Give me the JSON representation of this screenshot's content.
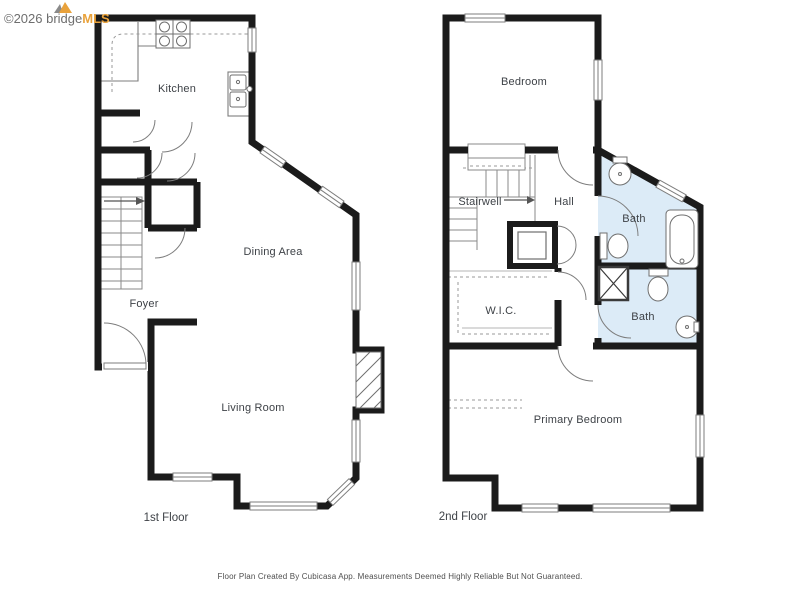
{
  "logo": {
    "prefix": "©2026 bridge",
    "suffix": "MLS"
  },
  "floors": {
    "first": {
      "label": "1st Floor",
      "rooms": {
        "kitchen": "Kitchen",
        "dining": "Dining Area",
        "foyer": "Foyer",
        "living": "Living Room"
      }
    },
    "second": {
      "label": "2nd Floor",
      "rooms": {
        "bedroom": "Bedroom",
        "stairwell": "Stairwell",
        "hall": "Hall",
        "bath_upper": "Bath",
        "wic": "W.I.C.",
        "bath_lower": "Bath",
        "primary": "Primary Bedroom"
      }
    }
  },
  "footer": {
    "disclaimer": "Floor Plan Created By Cubicasa App. Measurements Deemed Highly Reliable But Not Guaranteed."
  },
  "colors": {
    "wall": "#1b1b1b",
    "bath_fill": "#dcebf7",
    "fixture_line": "#7d7d7d",
    "label_text": "#3e4247",
    "brand_orange": "#e9a23b",
    "brand_gray": "#6e6e6e"
  }
}
